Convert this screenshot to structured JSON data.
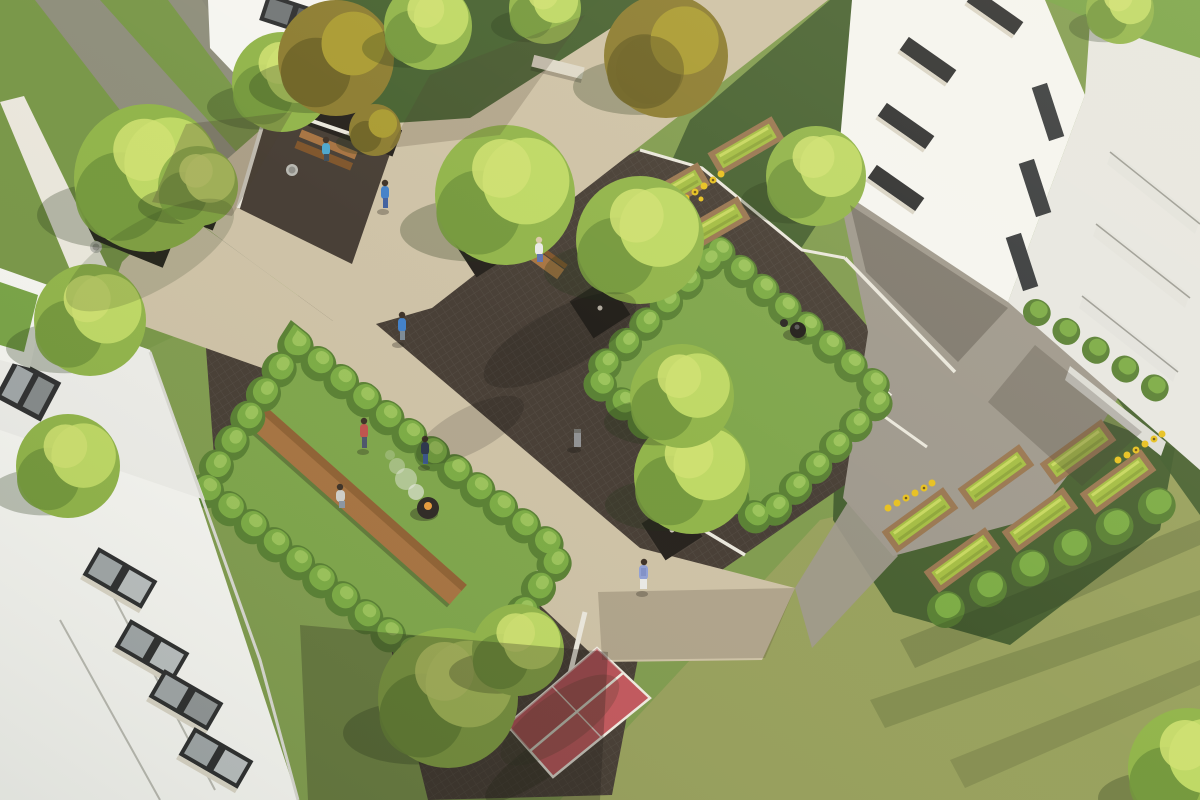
{
  "meta": {
    "title": "Aerial 3D architectural rendering of a residential courtyard",
    "description": "Bird's-eye visualization of a housing courtyard: white apartment buildings with green roofs, beige pedestrian paths, a dark paved plaza with trees in square planters, two sunken hedge-enclosed garden rooms with retaining walls, raised vegetable beds with sunflowers, shrub rows, benches, a fire bowl, a kettle grill, a red table-tennis table and residents walking and sitting on a sunny day.",
    "type": "3d-render",
    "view": "aerial / bird's-eye"
  },
  "palette": {
    "grass-base": "#7e9a4d",
    "grass-rich": "#6f9142",
    "grass-dry": "#9aa05e",
    "groundcover": "#3f5a2c",
    "lawn-room": "#7ca449",
    "path-beige": "#cdc1a6",
    "path-gray": "#8f8b7f",
    "plaza-gray": "#9d978c",
    "paving-dark": "#433a32",
    "paving-darker": "#332c26",
    "curb-white": "#eae7dd",
    "building-white": "#f5f5f2",
    "building-shade": "#e7e7e3",
    "roof-light": "#ededea",
    "roof-green": "#76a244",
    "window-dark": "#2b2c2e",
    "window-glass": "#9fa5a8",
    "window-sill": "#d9d4c7",
    "hedge-light": "#9cc45c",
    "hedge-mid": "#79aa42",
    "hedge-dark": "#567e31",
    "tree-light": "#bdd863",
    "tree-extra": "#cfe070",
    "tree-mid": "#8fb348",
    "tree-dark": "#6f9438",
    "autumn-mid": "#8a7a2e",
    "autumn-dark": "#695e22",
    "autumn-light": "#a8992f",
    "planter-dark": "#211d19",
    "trunk-light": "#cfc8bb",
    "wood": "#a5713f",
    "wood-dark": "#7c5128",
    "bed-frame": "#97744f",
    "bed-soil": "#5f5138",
    "veg-green": "#a2bc41",
    "veg-light": "#c6d75e",
    "sunflower": "#e7c01d",
    "sunflower-core": "#6f5512",
    "pingpong-red": "#c2555c",
    "pingpong-red-dark": "#a94850",
    "line-white": "#f0ece3",
    "concrete-bench": "#ddd8c9",
    "bin-gray": "#b7b7b1",
    "metal-gray": "#8f9092",
    "skin": "#e8c39a",
    "hair-dark": "#3a2e24",
    "p-blue": "#3e7ec9",
    "p-teal": "#49a5cd",
    "p-navy": "#2e3b55",
    "p-red": "#bf4f4b",
    "p-white": "#e9e9e7",
    "p-periwinkle": "#8f9fd6",
    "fire": "#e79b3b",
    "smoke": "rgba(240,240,238,0.75)",
    "shadow-cool": "rgba(30,45,18,0.28)",
    "shadow-warm": "rgba(70,58,44,0.30)",
    "shadow-deep": "rgba(25,22,18,0.28)"
  },
  "scene": {
    "elements": [
      {
        "name": "building-bottom-left",
        "label": "White apartment building, lower left, with window bands and balconies"
      },
      {
        "name": "building-top-right",
        "label": "White apartment building, upper right, two facades with dark windows, balconies and green roof"
      },
      {
        "name": "building-top-left-sliver",
        "label": "Corner of white building at top edge with window"
      },
      {
        "name": "main-path",
        "label": "Wide beige pedestrian path crossing diagonally"
      },
      {
        "name": "plaza-dark",
        "label": "Dark clinker-paved plaza with trees in square planters"
      },
      {
        "name": "plaza-gray",
        "label": "Gray concrete forecourt along right building"
      },
      {
        "name": "garden-room-left",
        "label": "Sunken hedge-enclosed garden room with long wooden table, fire bowl and three people"
      },
      {
        "name": "garden-room-right",
        "label": "Sunken hedge-enclosed garden room with kettle grill"
      },
      {
        "name": "raised-beds-top",
        "label": "Three raised vegetable beds with sunflowers"
      },
      {
        "name": "raised-beds-right",
        "label": "Six raised vegetable beds with sunflowers"
      },
      {
        "name": "ping-pong-table",
        "label": "Red table-tennis table on lawn"
      },
      {
        "name": "benches",
        "label": "Wooden benches at path and plaza, concrete bench at upper lawn"
      },
      {
        "name": "people",
        "label": "Eight residents: walking on paths, sitting on benches, standing on lawns"
      },
      {
        "name": "trees",
        "label": "Deciduous trees, some in dark square planters, some autumn colored"
      },
      {
        "name": "shrub-rows",
        "label": "Rows of clipped shrubs near beds and along building base"
      },
      {
        "name": "lawn",
        "label": "Green lawns, dry sunlit grass at bottom right"
      },
      {
        "name": "fire-bowl",
        "label": "Fire bowl with rising smoke"
      },
      {
        "name": "kettle-grill",
        "label": "Black kettle grill"
      },
      {
        "name": "bollard-light",
        "label": "Small bollard light on plaza"
      },
      {
        "name": "litter-bins",
        "label": "Gray litter bins beside benches"
      },
      {
        "name": "white-walls",
        "label": "White retaining walls and curbs around sunken gardens"
      }
    ]
  }
}
